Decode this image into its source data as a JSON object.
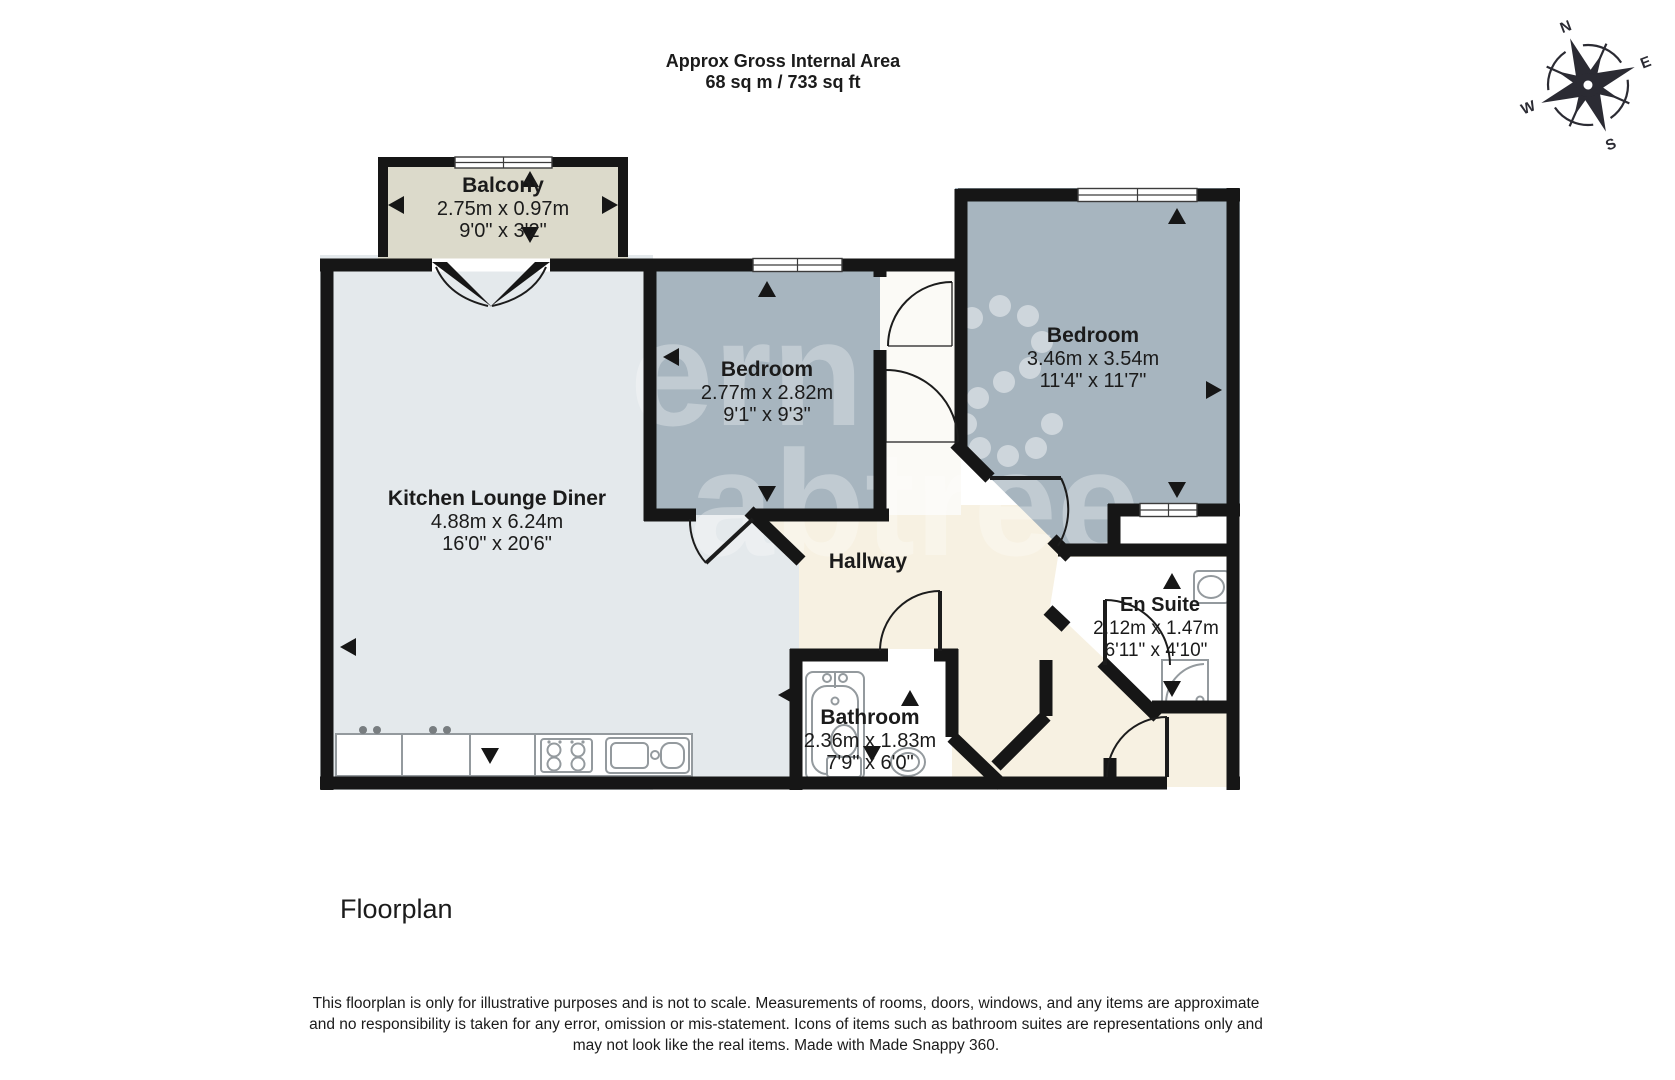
{
  "header": {
    "line1": "Approx Gross Internal Area",
    "line2": "68 sq m / 733 sq ft"
  },
  "compass": {
    "n": "N",
    "e": "E",
    "s": "S",
    "w": "W"
  },
  "rooms": {
    "balcony": {
      "name": "Balcony",
      "metric": "2.75m x 0.97m",
      "imperial": "9'0\" x 3'2\""
    },
    "kitchen": {
      "name": "Kitchen Lounge Diner",
      "metric": "4.88m x 6.24m",
      "imperial": "16'0\" x 20'6\""
    },
    "bedroom1": {
      "name": "Bedroom",
      "metric": "2.77m x 2.82m",
      "imperial": "9'1\" x 9'3\""
    },
    "bedroom2": {
      "name": "Bedroom",
      "metric": "3.46m x 3.54m",
      "imperial": "11'4\" x 11'7\""
    },
    "hallway": {
      "name": "Hallway"
    },
    "bathroom": {
      "name": "Bathroom",
      "metric": "2.36m x 1.83m",
      "imperial": "7'9\" x 6'0\""
    },
    "ensuite": {
      "name": "En Suite",
      "metric": "2.12m x 1.47m",
      "imperial": "6'11\" x 4'10\""
    }
  },
  "caption": "Floorplan",
  "disclaimer": {
    "line1": "This floorplan is only for illustrative purposes and is not to scale. Measurements of rooms, doors, windows, and any items are approximate",
    "line2": "and no responsibility is taken for any error, omission or mis-statement. Icons of items such as bathroom suites are representations only and",
    "line3": "may not look like the real items. Made with Made Snappy 360."
  },
  "colors": {
    "wall": "#161616",
    "kitchen": "#e4e9ec",
    "bedroom": "#a7b5bf",
    "hallway": "#f7f1e2",
    "balcony": "#dcdacb",
    "room_white": "#ffffff",
    "closet": "#fbfaf6"
  }
}
